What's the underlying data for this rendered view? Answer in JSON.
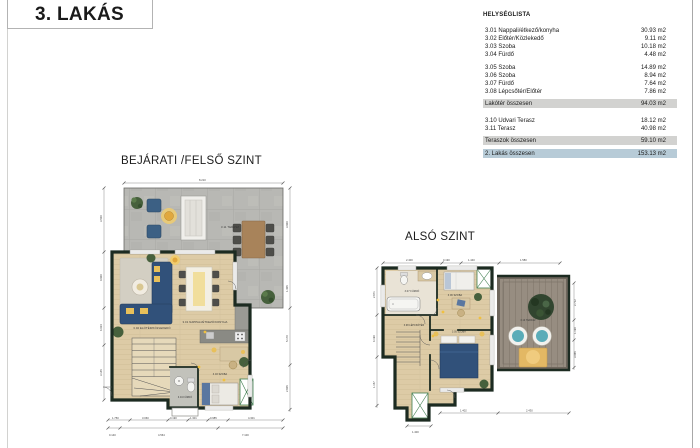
{
  "page": {
    "title": "3. LAKÁS"
  },
  "room_list": {
    "header": "HELYSÉGLISTA",
    "group1": [
      {
        "name": "3.01 Nappali/étkező/konyha",
        "area": "30.93 m2"
      },
      {
        "name": "3.02 Előtér/Közlekedő",
        "area": "9.11 m2"
      },
      {
        "name": "3.03 Szoba",
        "area": "10.18 m2"
      },
      {
        "name": "3.04 Fürdő",
        "area": "4.48 m2"
      }
    ],
    "group2": [
      {
        "name": "3.05 Szoba",
        "area": "14.89 m2"
      },
      {
        "name": "3.06 Szoba",
        "area": "8.94 m2"
      },
      {
        "name": "3.07 Fürdő",
        "area": "7.64 m2"
      },
      {
        "name": "3.08 Lépcsőtér/Előtér",
        "area": "7.86 m2"
      }
    ],
    "living_total": {
      "name": "Lakótér összesen",
      "area": "94.03 m2"
    },
    "group3": [
      {
        "name": "3.10 Udvari Terasz",
        "area": "18.12 m2"
      },
      {
        "name": "3.11 Terasz",
        "area": "40.98 m2"
      }
    ],
    "terrace_total": {
      "name": "Teraszok összesen",
      "area": "59.10 m2"
    },
    "grand_total": {
      "name": "2. Lakás összesen",
      "area": "153.13 m2"
    }
  },
  "plans": {
    "upper": {
      "title": "BEJÁRATI /FELSŐ SZINT",
      "labels": {
        "terrace": "3.11 TERASZ",
        "living": "3.01 NAPPALI/ÉTKEZŐ/KONYHA",
        "hall": "3.02 ELŐTÉR/KÖZLEKEDŐ",
        "bath": "3.04 FÜRDŐ",
        "bedroom": "3.03 SZOBA"
      },
      "dims": {
        "top": "8.210",
        "left": [
          "3.500",
          "0.900",
          "4.024",
          "3.145"
        ],
        "right": [
          "3.900",
          "1.405",
          "5.170",
          "2.605"
        ],
        "bottom1": [
          "1.750",
          "3.060",
          "0.190",
          "1.301",
          "0.985",
          "4.301"
        ],
        "bottom2": [
          "0.140",
          "4.564",
          "7.100"
        ]
      }
    },
    "lower": {
      "title": "ALSÓ SZINT",
      "labels": {
        "bath": "3.07 FÜRDŐ",
        "room1": "3.06 SZOBA",
        "stairs": "3.08 LÉPCSŐTÉR",
        "room2": "3.05 SZOBA",
        "terrace": "3.10 TERASZ"
      },
      "dims": {
        "top": [
          "2.400",
          "0.190",
          "1.440",
          "1.580"
        ],
        "left": [
          "2.671",
          "4.190",
          "1.157"
        ],
        "right": [
          "2.712",
          "1.190",
          "3.065"
        ],
        "bottom": [
          "1.402",
          "2.430"
        ],
        "bottom2": "1.400"
      }
    }
  },
  "colors": {
    "wall": "#1c2b21",
    "floor": "#ddcba6",
    "terrace_concrete": "#b8b8b4",
    "deck": "#978d81",
    "sofa_navy": "#31517a",
    "accent_yellow": "#e8c05a",
    "plant_green": "#46603c",
    "teal": "#5aacb8",
    "summary_gray": "#d2d2d0",
    "summary_blue": "#b7cbd7"
  }
}
